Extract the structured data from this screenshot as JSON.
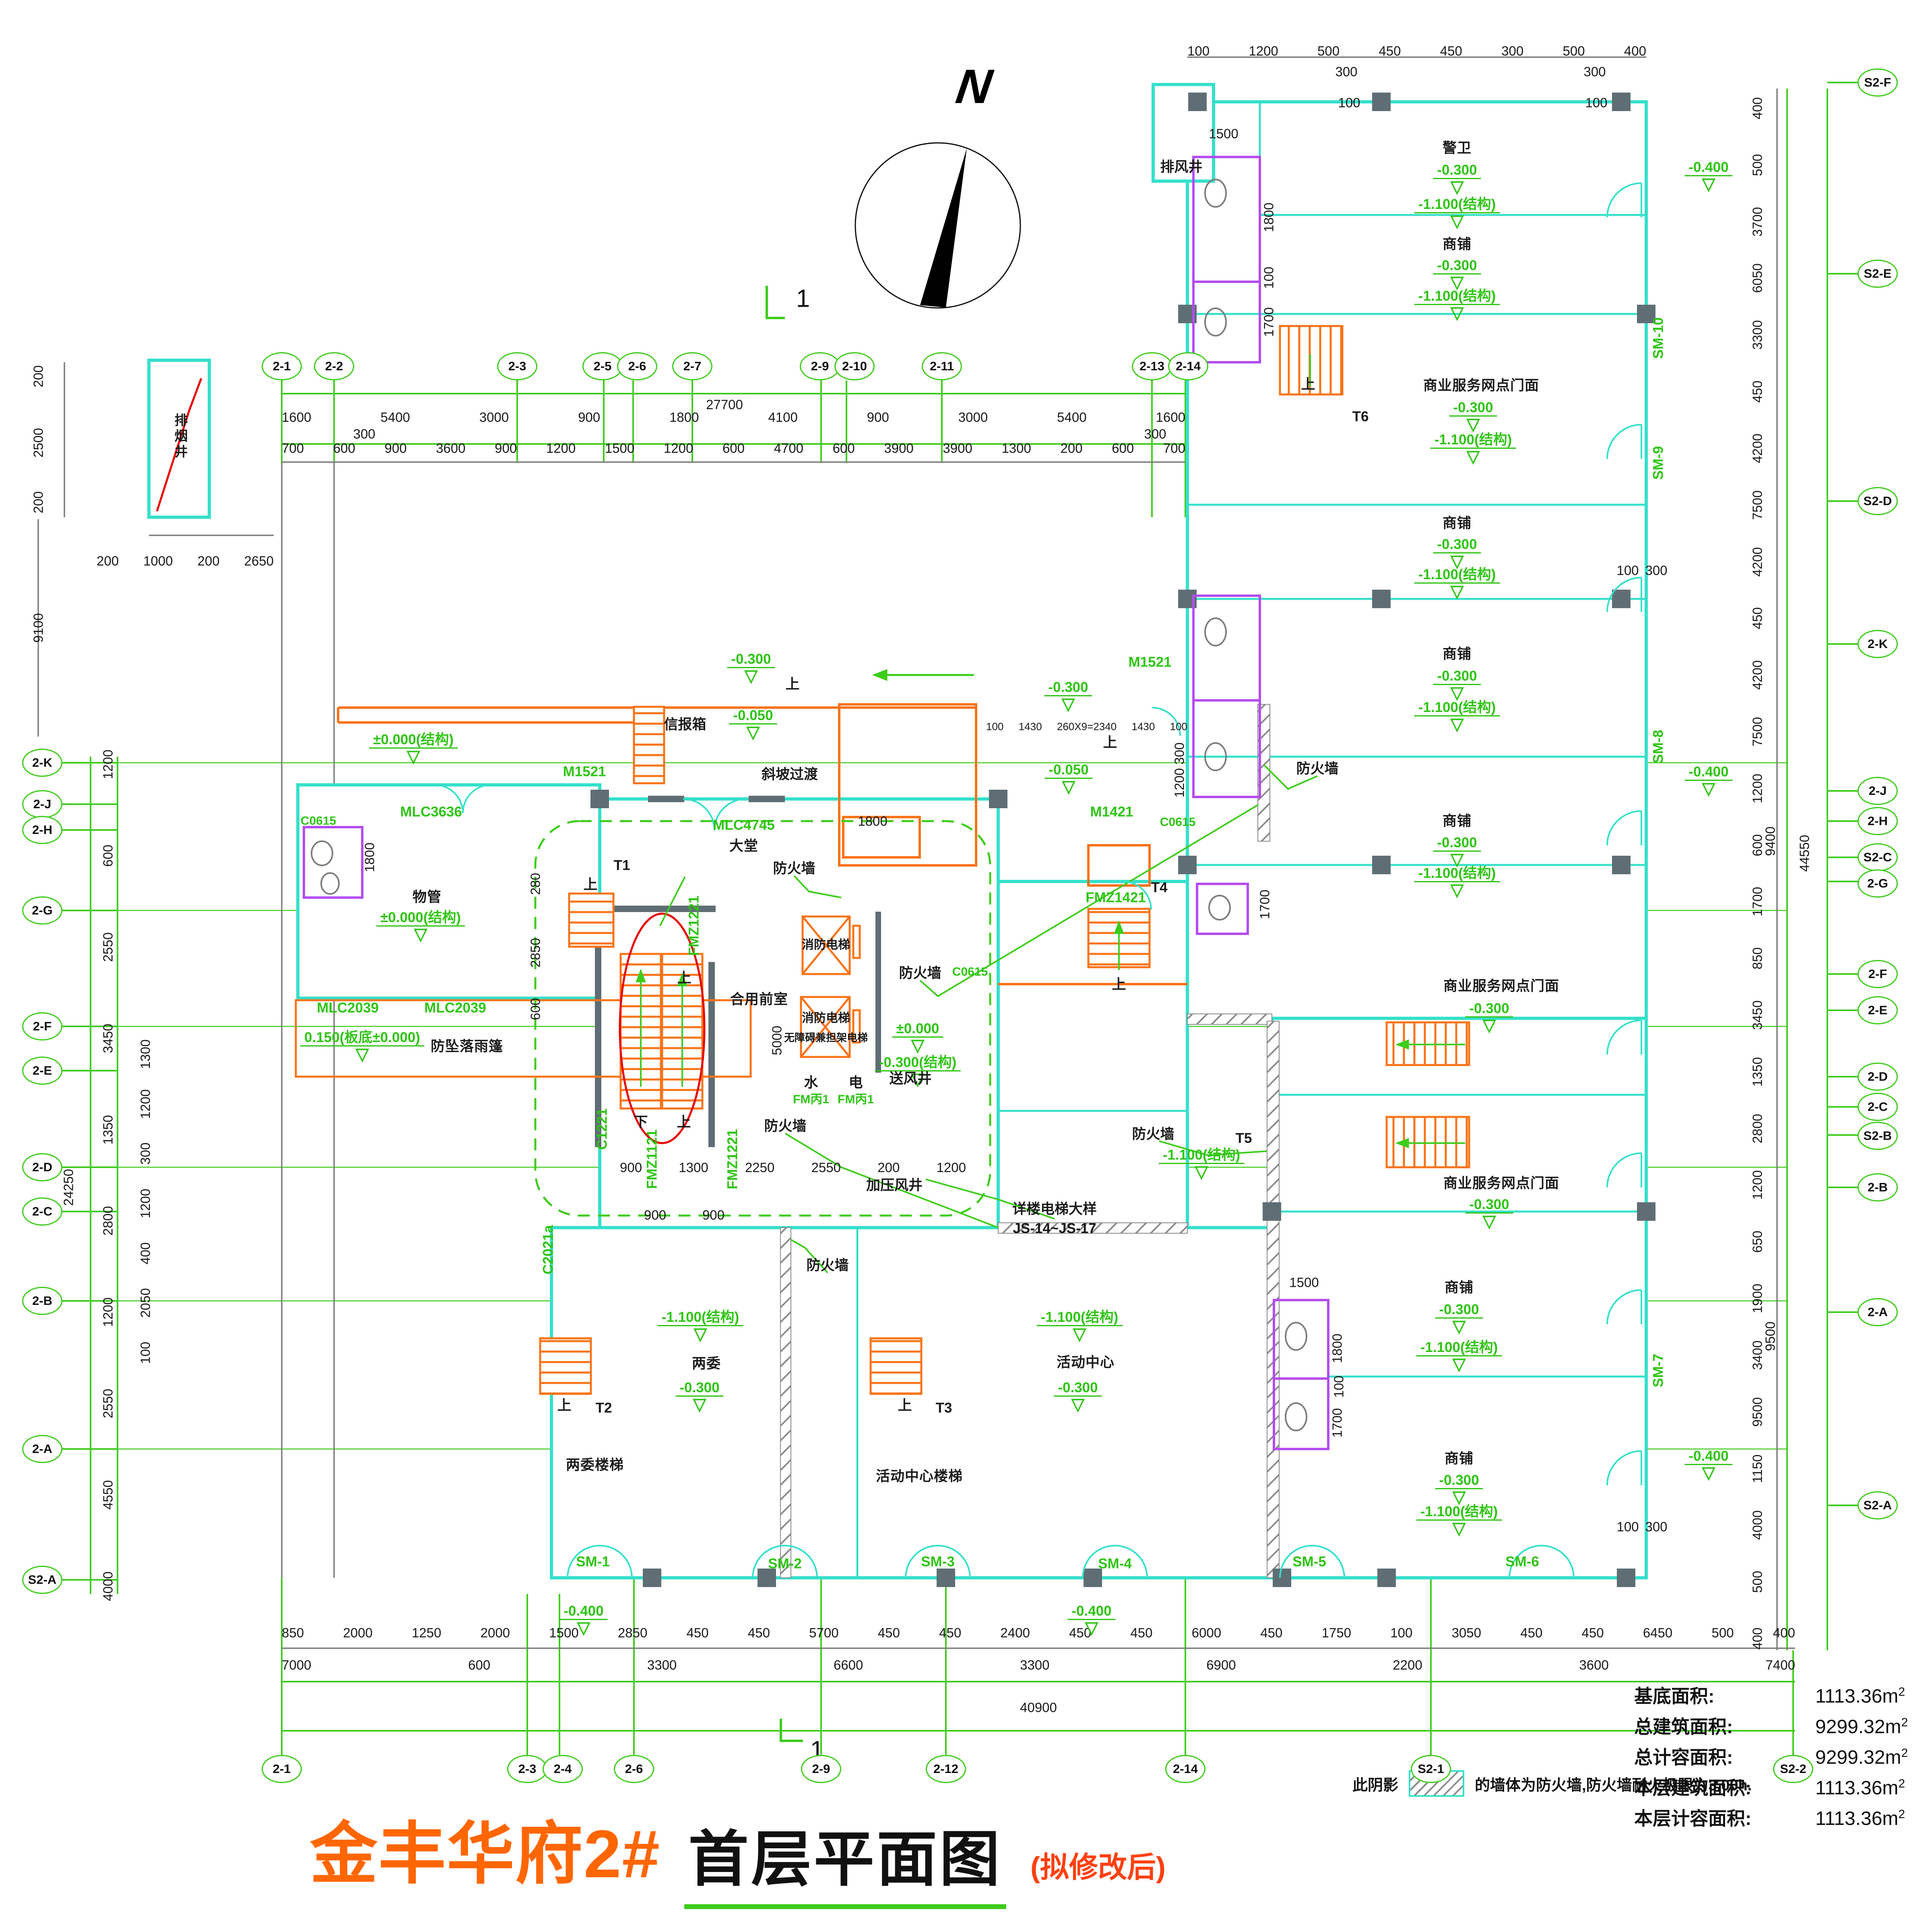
{
  "title": {
    "project": "金丰华府2#",
    "drawing": "首层平面图",
    "revision": "(拟修改后)"
  },
  "icons": {
    "north": "N",
    "level_triangle": "▽"
  },
  "section_marks": {
    "top": "1",
    "bottom": "1"
  },
  "legend": {
    "prefix": "此阴影",
    "text": "的墙体为防火墙,防火墙耐火极限为3.00h."
  },
  "area_table": {
    "rows": [
      {
        "label": "基底面积:",
        "value": "1113.36m",
        "sup": "2"
      },
      {
        "label": "总建筑面积:",
        "value": "9299.32m",
        "sup": "2"
      },
      {
        "label": "总计容面积:",
        "value": "9299.32m",
        "sup": "2"
      },
      {
        "label": "本层建筑面积:",
        "value": "1113.36m",
        "sup": "2"
      },
      {
        "label": "本层计容面积:",
        "value": "1113.36m",
        "sup": "2"
      }
    ]
  },
  "axes": {
    "top": [
      "2-1",
      "2-2",
      "2-3",
      "2-5",
      "2-6",
      "2-7",
      "2-9",
      "2-10",
      "2-11",
      "2-13",
      "2-14"
    ],
    "bottom": [
      "2-1",
      "2-3",
      "2-4",
      "2-6",
      "2-9",
      "2-12",
      "2-14",
      "S2-1",
      "S2-2"
    ],
    "left": [
      "2-K",
      "2-J",
      "2-H",
      "2-G",
      "2-F",
      "2-E",
      "2-D",
      "2-C",
      "2-B",
      "2-A",
      "S2-A"
    ],
    "right": [
      "S2-F",
      "S2-E",
      "S2-D",
      "2-K",
      "2-J",
      "2-H",
      "S2-C",
      "2-G",
      "2-F",
      "2-E",
      "2-D",
      "2-C",
      "S2-B",
      "2-B",
      "2-A",
      "S2-A"
    ]
  },
  "dims": {
    "top_total": "27700",
    "top_row1": [
      "1600",
      "5400",
      "3000",
      "900",
      "1800",
      "4100",
      "900",
      "3000",
      "5400",
      "1600"
    ],
    "top_offset_left": "300",
    "top_offset_right": "300",
    "top_row2": [
      "700",
      "600",
      "900",
      "3600",
      "900",
      "1200",
      "1500",
      "1200",
      "600",
      "4700",
      "600",
      "3900",
      "3900",
      "1300",
      "200",
      "600",
      "700"
    ],
    "bottom_row1": [
      "850",
      "2000",
      "1250",
      "2000",
      "1500",
      "2850",
      "450",
      "450",
      "5700",
      "450",
      "450",
      "2400",
      "450",
      "450",
      "6000",
      "450",
      "1750",
      "100",
      "3050",
      "450",
      "450",
      "6450",
      "500",
      "400"
    ],
    "bottom_row2": [
      "7000",
      "600",
      "3300",
      "6600",
      "3300",
      "6900",
      "2200",
      "3600",
      "7400"
    ],
    "bottom_total": "40900",
    "left_outer": [
      "1200",
      "600",
      "2550",
      "3450",
      "1350",
      "2800",
      "1200",
      "2550",
      "4550",
      "4000"
    ],
    "left_inner": [
      "1300",
      "1200",
      "300",
      "1200",
      "400",
      "2050",
      "100"
    ],
    "left_total": "24250",
    "left_top": [
      "200",
      "2500",
      "200"
    ],
    "left_shaft": "9100",
    "left_top_row": [
      "200",
      "1000",
      "200",
      "2650"
    ],
    "right_col": [
      "400",
      "500",
      "3700",
      "6050",
      "3300",
      "450",
      "4200",
      "7500",
      "4200",
      "450",
      "4200",
      "7500",
      "1200",
      "600",
      "1700",
      "850",
      "3450",
      "1350",
      "2800",
      "1200",
      "650",
      "1900",
      "3400",
      "9500",
      "1150",
      "4000",
      "500",
      "400"
    ],
    "right_total": "44550",
    "right_9400": "9400",
    "right_9500": "9500",
    "wing_top_row": [
      "100",
      "1200",
      "500",
      "450",
      "450",
      "300",
      "500",
      "400"
    ],
    "core_row1": [
      "900",
      "1300",
      "2250",
      "2550",
      "200",
      "1200"
    ],
    "core_row2": [
      "900",
      "900"
    ],
    "lobby_door": "1800",
    "front_room_h": "5000",
    "ramp_row": [
      "100",
      "1430",
      "260X9=2340",
      "1430",
      "100"
    ],
    "ramp_300": "300",
    "ramp_1200": "1200",
    "wuguan_col": [
      "280",
      "2850",
      "600"
    ],
    "wuguan_wc": "1800",
    "wc_w": "1500",
    "wc_h1": "1800",
    "wc_h2": "100",
    "wc_h3": "1700",
    "col_300": "300",
    "col_100": "100"
  },
  "rooms": {
    "shop": "商铺",
    "guard": "警卫",
    "facade": "商业服务网点门面",
    "lobby": "大堂",
    "property": "物管",
    "committee": "两委",
    "committee_stair": "两委楼梯",
    "activity": "活动中心",
    "activity_stair": "活动中心楼梯",
    "front_room": "合用前室",
    "water": "水",
    "elec": "电",
    "air_supply": "送风井",
    "pressur": "加压风井",
    "smoke_shaft": "排烟井",
    "exhaust_shaft": "排风井",
    "mailbox": "信报箱",
    "slope": "斜坡过渡",
    "firewall": "防火墙",
    "fire_elev": "消防电梯",
    "stretcher_elev": "无障碍兼担架电梯",
    "canopy": "防坠落雨篷",
    "elev_note1": "详楼电梯大样",
    "elev_note2": "JS-14~JS-17"
  },
  "levels": {
    "m300": "-0.300",
    "m1100": "-1.100(结构)",
    "m400": "-0.400",
    "m050": "-0.050",
    "z000s": "±0.000(结构)",
    "z000": "±0.000",
    "m300s": "-0.300(结构)",
    "p150": "0.150(板底±0.000)"
  },
  "codes": {
    "mlc4745": "MLC4745",
    "mlc3636": "MLC3636",
    "mlc2039": "MLC2039",
    "c0615": "C0615",
    "m1521": "M1521",
    "m1421": "M1421",
    "fmz1421": "FMZ1421",
    "fmz1221": "FMZ1221",
    "fmz1121": "FMZ1121",
    "c1221": "C1221",
    "c2021a": "C2021a",
    "fmb1": "FM丙1"
  },
  "stairs": {
    "t1": "T1",
    "t2": "T2",
    "t3": "T3",
    "t4": "T4",
    "t5": "T5",
    "t6": "T6",
    "up": "上",
    "down": "下"
  },
  "sm": {
    "s1": "SM-1",
    "s2": "SM-2",
    "s3": "SM-3",
    "s4": "SM-4",
    "s5": "SM-5",
    "s6": "SM-6",
    "s7": "SM-7",
    "s8": "SM-8",
    "s9": "SM-9",
    "s10": "SM-10"
  }
}
